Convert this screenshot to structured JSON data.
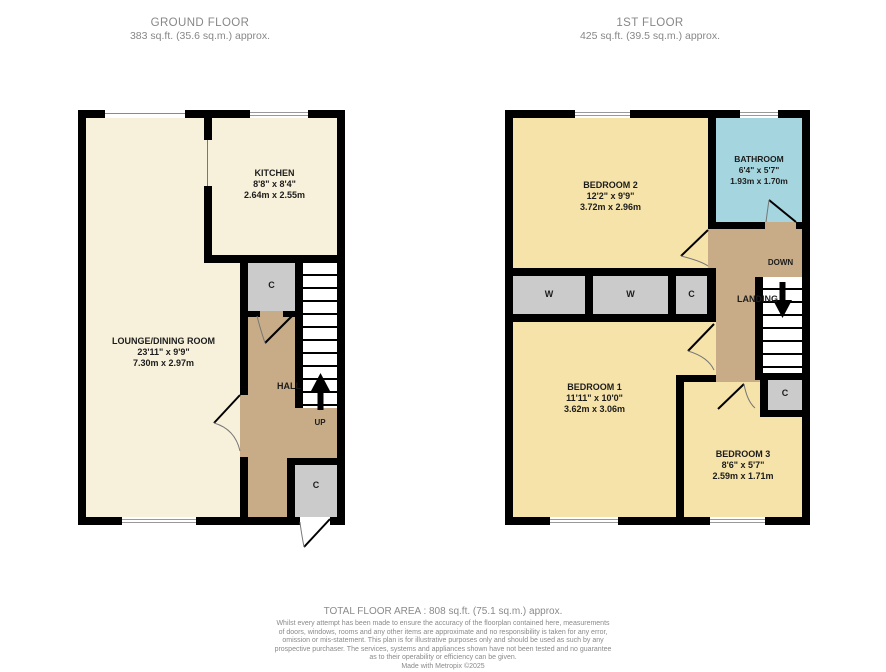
{
  "headers": {
    "ground": {
      "title": "GROUND FLOOR",
      "area": "383 sq.ft. (35.6 sq.m.) approx."
    },
    "first": {
      "title": "1ST FLOOR",
      "area": "425 sq.ft. (39.5 sq.m.) approx."
    }
  },
  "ground_floor": {
    "lounge": {
      "name": "LOUNGE/DINING ROOM",
      "imperial": "23'11\" x 9'9\"",
      "metric": "7.30m x 2.97m"
    },
    "kitchen": {
      "name": "KITCHEN",
      "imperial": "8'8\" x 8'4\"",
      "metric": "2.64m x 2.55m"
    },
    "hall": {
      "name": "HALL"
    },
    "up": "UP",
    "cupboard1": "C",
    "cupboard2": "C"
  },
  "first_floor": {
    "bedroom1": {
      "name": "BEDROOM 1",
      "imperial": "11'11\" x 10'0\"",
      "metric": "3.62m x 3.06m"
    },
    "bedroom2": {
      "name": "BEDROOM 2",
      "imperial": "12'2\" x 9'9\"",
      "metric": "3.72m x 2.96m"
    },
    "bedroom3": {
      "name": "BEDROOM 3",
      "imperial": "8'6\" x 5'7\"",
      "metric": "2.59m x 1.71m"
    },
    "bathroom": {
      "name": "BATHROOM",
      "imperial": "6'4\" x 5'7\"",
      "metric": "1.93m x 1.70m"
    },
    "landing": {
      "name": "LANDING"
    },
    "down": "DOWN",
    "wardrobe1": "W",
    "wardrobe2": "W",
    "cupboard1": "C",
    "cupboard2": "C"
  },
  "footer": {
    "total": "TOTAL FLOOR AREA : 808 sq.ft. (75.1 sq.m.) approx.",
    "disclaimer_lines": [
      "Whilst every attempt has been made to ensure the accuracy of the floorplan contained here, measurements",
      "of doors, windows, rooms and any other items are approximate and no responsibility is taken for any error,",
      "omission or mis-statement. This plan is for illustrative purposes only and should be used as such by any",
      "prospective purchaser. The services, systems and appliances shown have not been tested and no guarantee",
      "as to their operability or efficiency can be given."
    ],
    "credit": "Made with Metropix ©2025"
  },
  "colors": {
    "wall": "#000000",
    "ground_room": "#F7F1DB",
    "bedroom": "#F6E3A9",
    "hall_landing": "#C7AC87",
    "bathroom": "#A5D6DF",
    "closet": "#CBCBCB",
    "header_text": "#878787"
  }
}
